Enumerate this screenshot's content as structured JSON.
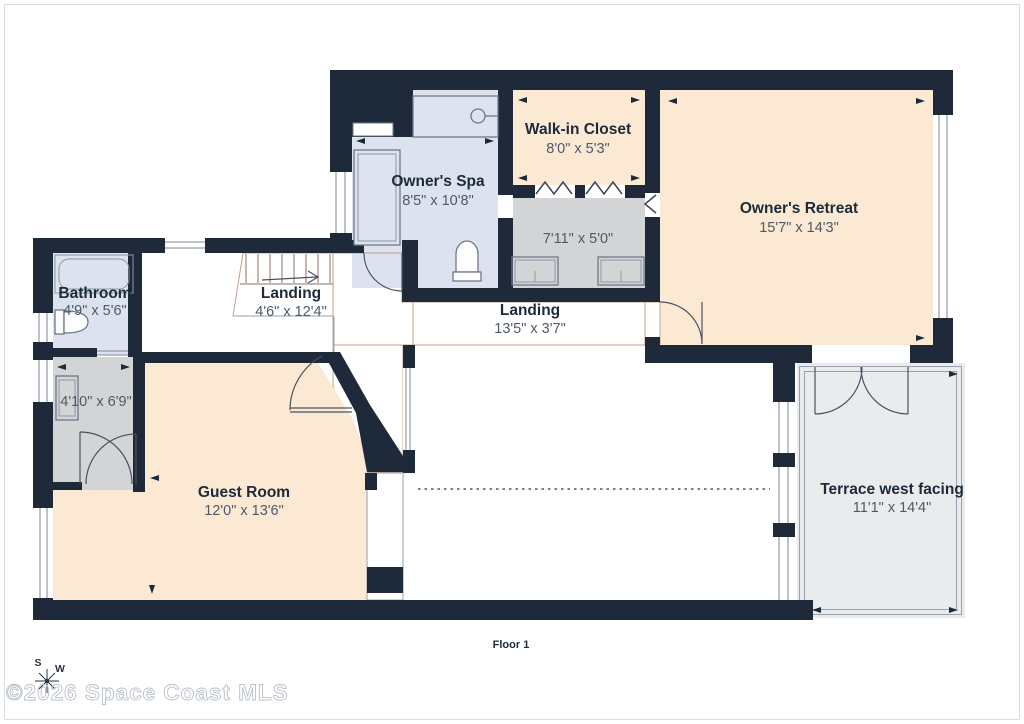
{
  "page": {
    "floor_label": "Floor 1",
    "watermark": "©2026 Space Coast MLS",
    "compass": {
      "south_label": "S",
      "west_label": "W"
    }
  },
  "rooms": [
    {
      "name": "Owner's Spa",
      "dims": "8'5\" x 10'8\""
    },
    {
      "name": "Walk-in Closet",
      "dims": "8'0\" x 5'3\""
    },
    {
      "name": "",
      "dims": "7'11\" x 5'0\""
    },
    {
      "name": "Owner's Retreat",
      "dims": "15'7\" x 14'3\""
    },
    {
      "name": "Landing",
      "dims": "4'6\" x 12'4\""
    },
    {
      "name": "Landing",
      "dims": "13'5\" x 3'7\""
    },
    {
      "name": "Bathroom",
      "dims": "4'9\" x 5'6\""
    },
    {
      "name": "",
      "dims": "4'10\" x 6'9\""
    },
    {
      "name": "Guest Room",
      "dims": "12'0\" x 13'6\""
    },
    {
      "name": "Terrace west facing",
      "dims": "11'1\" x 14'4\""
    }
  ],
  "colors": {
    "wall": "#1e2a3a",
    "bedroom_cream": "#fbe9d4",
    "landing_pink": "#f3d7c5",
    "closet_gray": "#d2d4d6",
    "bath_blue": "#dce3ef",
    "terrace_gray": "#e9ebec",
    "strip_gray": "#cfd1d3",
    "window_white": "#ffffff",
    "dim_text": "#4f5a68",
    "name_text": "#1c2a3a",
    "watermark_gray": "#b9c0ca"
  }
}
